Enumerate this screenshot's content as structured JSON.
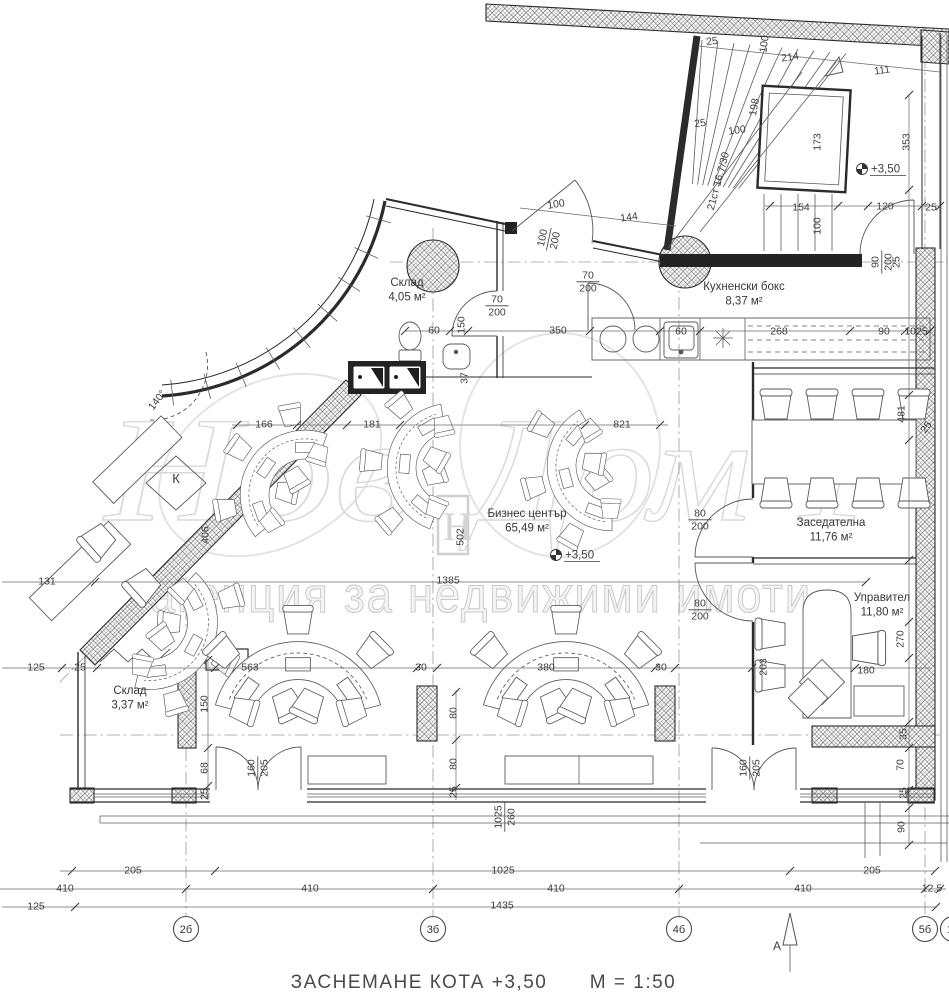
{
  "title": {
    "main": "ЗАСНЕМАНЕ  КОТА  +3,50",
    "scale": "М = 1:50"
  },
  "watermark": {
    "script_left": "Нов",
    "script_right": "Дом 1",
    "logo_letter": "Н",
    "subtitle": "агенция за недвижими имоти"
  },
  "rooms": [
    {
      "name": "Склад",
      "area": "4,05 м²",
      "x": 407,
      "y": 286
    },
    {
      "name": "Кухненски бокс",
      "area": "8,37 м²",
      "x": 744,
      "y": 290
    },
    {
      "name": "Бизнес център",
      "area": "65,49 м²",
      "x": 527,
      "y": 517
    },
    {
      "name": "Заседателна",
      "area": "11,76 м²",
      "x": 831,
      "y": 526
    },
    {
      "name": "Управител",
      "area": "11,80 м²",
      "x": 882,
      "y": 601
    },
    {
      "name": "Склад",
      "area": "3,37 м²",
      "x": 130,
      "y": 694
    }
  ],
  "elevation_marks": [
    {
      "text": "+3,50",
      "x": 862,
      "y": 169
    },
    {
      "text": "+3,50",
      "x": 556,
      "y": 555
    }
  ],
  "grid_bubbles": [
    {
      "label": "2б",
      "x": 186,
      "y": 929
    },
    {
      "label": "3б",
      "x": 433,
      "y": 929
    },
    {
      "label": "4б",
      "x": 679,
      "y": 929
    },
    {
      "label": "5б",
      "x": 925,
      "y": 929
    },
    {
      "label": "1а",
      "x": 953,
      "y": 929
    }
  ],
  "section_marker": {
    "label": "А"
  },
  "equipment_labels": [
    {
      "text": "К",
      "x": 176,
      "y": 483
    }
  ],
  "dimensions": [
    {
      "t": "25",
      "x": 712,
      "y": 41,
      "r": -7
    },
    {
      "t": "100",
      "x": 764,
      "y": 44,
      "r": -82
    },
    {
      "t": "214",
      "x": 790,
      "y": 57,
      "r": -8
    },
    {
      "t": "111",
      "x": 882,
      "y": 70,
      "r": -8
    },
    {
      "t": "198",
      "x": 754,
      "y": 107,
      "r": -80
    },
    {
      "t": "100",
      "x": 737,
      "y": 130,
      "r": -8
    },
    {
      "t": "25",
      "x": 700,
      "y": 123,
      "r": -8
    },
    {
      "t": "21ст 16.7/30",
      "x": 718,
      "y": 181,
      "r": -75
    },
    {
      "t": "173",
      "x": 817,
      "y": 142,
      "r": -90
    },
    {
      "t": "353",
      "x": 906,
      "y": 142,
      "r": -90
    },
    {
      "t": "154",
      "x": 801,
      "y": 207
    },
    {
      "t": "120",
      "x": 885,
      "y": 206
    },
    {
      "t": "25",
      "x": 931,
      "y": 207
    },
    {
      "t": "100",
      "x": 817,
      "y": 226,
      "r": -90
    },
    {
      "t": "90|200",
      "x": 881,
      "y": 262,
      "r": -90,
      "f": 1
    },
    {
      "t": "25",
      "x": 896,
      "y": 262,
      "r": -90
    },
    {
      "t": "100",
      "x": 556,
      "y": 204,
      "r": -9
    },
    {
      "t": "144",
      "x": 629,
      "y": 217,
      "r": -8
    },
    {
      "t": "100|200",
      "x": 548,
      "y": 239,
      "r": -78,
      "f": 1
    },
    {
      "t": "70|200",
      "x": 588,
      "y": 281,
      "f": 1
    },
    {
      "t": "70|200",
      "x": 497,
      "y": 305,
      "f": 1
    },
    {
      "t": "60",
      "x": 434,
      "y": 330
    },
    {
      "t": "150",
      "x": 461,
      "y": 325,
      "r": -90
    },
    {
      "t": "350",
      "x": 558,
      "y": 330
    },
    {
      "t": "37",
      "x": 464,
      "y": 378,
      "r": -90
    },
    {
      "t": "60",
      "x": 681,
      "y": 331
    },
    {
      "t": "268",
      "x": 779,
      "y": 331
    },
    {
      "t": "90",
      "x": 884,
      "y": 331
    },
    {
      "t": "1025",
      "x": 916,
      "y": 331
    },
    {
      "t": "140°",
      "x": 157,
      "y": 400,
      "r": -52
    },
    {
      "t": "166",
      "x": 264,
      "y": 424
    },
    {
      "t": "181",
      "x": 372,
      "y": 424
    },
    {
      "t": "821",
      "x": 622,
      "y": 424
    },
    {
      "t": "406",
      "x": 205,
      "y": 535,
      "r": -90
    },
    {
      "t": "131",
      "x": 47,
      "y": 581
    },
    {
      "t": "502",
      "x": 460,
      "y": 537,
      "r": -90
    },
    {
      "t": "1385",
      "x": 448,
      "y": 580
    },
    {
      "t": "80|200",
      "x": 700,
      "y": 519,
      "f": 1
    },
    {
      "t": "80|200",
      "x": 700,
      "y": 609,
      "f": 1
    },
    {
      "t": "481",
      "x": 901,
      "y": 414,
      "r": -90
    },
    {
      "t": "25",
      "x": 926,
      "y": 427,
      "r": -55
    },
    {
      "t": "125",
      "x": 36,
      "y": 667
    },
    {
      "t": "25",
      "x": 80,
      "y": 667
    },
    {
      "t": "150",
      "x": 204,
      "y": 704,
      "r": -90
    },
    {
      "t": "68",
      "x": 204,
      "y": 768,
      "r": -90
    },
    {
      "t": "25",
      "x": 204,
      "y": 794,
      "r": -90
    },
    {
      "t": "563",
      "x": 250,
      "y": 667
    },
    {
      "t": "30",
      "x": 421,
      "y": 667
    },
    {
      "t": "380",
      "x": 546,
      "y": 667
    },
    {
      "t": "30",
      "x": 661,
      "y": 667
    },
    {
      "t": "80",
      "x": 453,
      "y": 713,
      "r": -90
    },
    {
      "t": "80",
      "x": 453,
      "y": 764,
      "r": -90
    },
    {
      "t": "25",
      "x": 453,
      "y": 792,
      "r": -90
    },
    {
      "t": "160|205",
      "x": 257,
      "y": 768,
      "r": -90,
      "f": 1
    },
    {
      "t": "160|205",
      "x": 749,
      "y": 768,
      "r": -90,
      "f": 1
    },
    {
      "t": "1025|260",
      "x": 504,
      "y": 817,
      "r": -90,
      "f": 1
    },
    {
      "t": "203",
      "x": 763,
      "y": 667,
      "r": -90
    },
    {
      "t": "180",
      "x": 866,
      "y": 670
    },
    {
      "t": "270",
      "x": 900,
      "y": 639,
      "r": -90
    },
    {
      "t": "35",
      "x": 903,
      "y": 734,
      "r": -90
    },
    {
      "t": "70",
      "x": 900,
      "y": 765,
      "r": -90
    },
    {
      "t": "25",
      "x": 903,
      "y": 793,
      "r": -90
    },
    {
      "t": "90",
      "x": 901,
      "y": 827,
      "r": -90
    },
    {
      "t": "205",
      "x": 133,
      "y": 870
    },
    {
      "t": "1025",
      "x": 503,
      "y": 870
    },
    {
      "t": "205",
      "x": 872,
      "y": 870
    },
    {
      "t": "410",
      "x": 65,
      "y": 888
    },
    {
      "t": "410",
      "x": 310,
      "y": 888
    },
    {
      "t": "410",
      "x": 556,
      "y": 888
    },
    {
      "t": "410",
      "x": 803,
      "y": 888
    },
    {
      "t": "12,5",
      "x": 932,
      "y": 888
    },
    {
      "t": "125",
      "x": 36,
      "y": 906
    },
    {
      "t": "1435",
      "x": 502,
      "y": 905
    }
  ]
}
